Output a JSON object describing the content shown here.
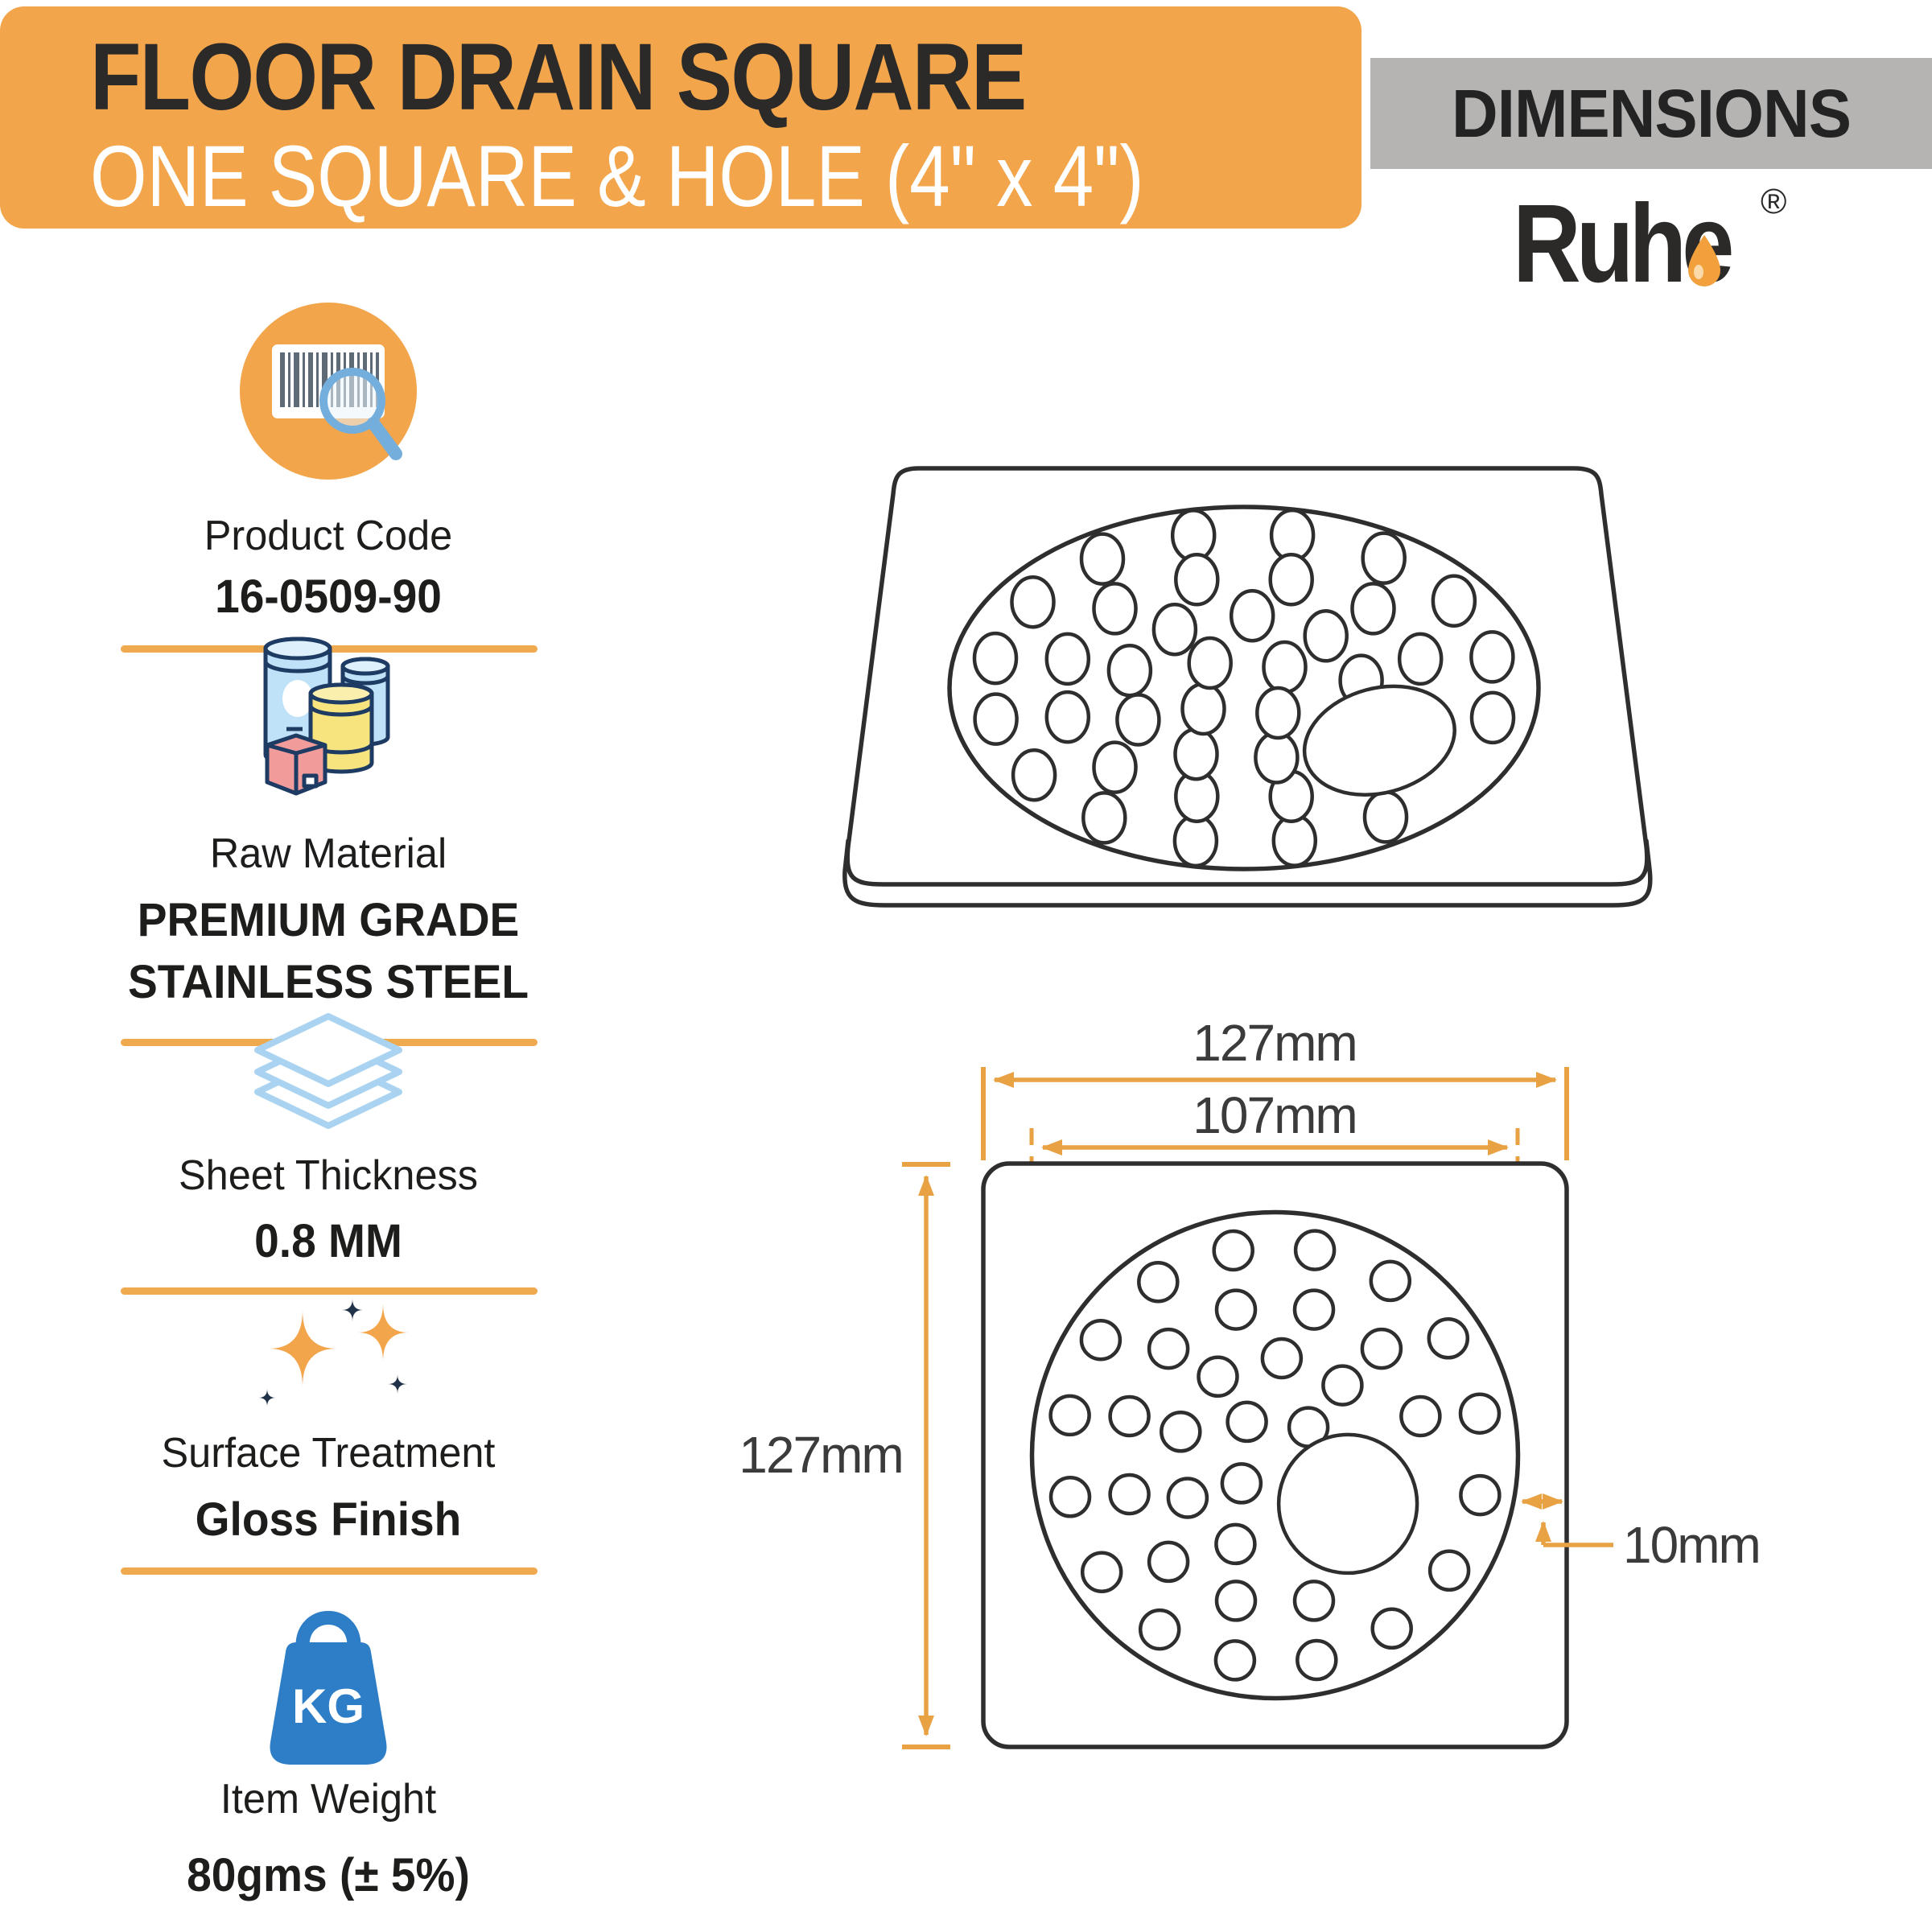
{
  "header": {
    "title_line1": "FLOOR DRAIN SQUARE",
    "title_line2": "ONE SQUARE & HOLE (4\" x 4\")"
  },
  "dimensions_panel": {
    "title": "DIMENSIONS"
  },
  "brand": {
    "name": "Ruhe",
    "registered_mark": "®"
  },
  "specs": [
    {
      "icon": "barcode-search-icon",
      "label": "Product Code",
      "value": "16-0509-90"
    },
    {
      "icon": "material-containers-icon",
      "label": "Raw Material",
      "value_line1": "PREMIUM GRADE",
      "value_line2": "STAINLESS STEEL"
    },
    {
      "icon": "sheet-stack-icon",
      "label": "Sheet Thickness",
      "value": "0.8 MM"
    },
    {
      "icon": "sparkles-icon",
      "label": "Surface Treatment",
      "value": "Gloss Finish"
    },
    {
      "icon": "kg-weight-icon",
      "label": "Item Weight",
      "value": "80gms (± 5%)"
    }
  ],
  "diagram": {
    "labels": {
      "outer_width": "127mm",
      "inner_width": "107mm",
      "outer_height": "127mm",
      "edge_offset": "10mm"
    },
    "pattern": {
      "hole_r": 0.078,
      "rings": [
        {
          "r": 0.86,
          "n": 16,
          "start": -79
        },
        {
          "r": 0.62,
          "n": 12,
          "start": -75
        },
        {
          "r": 0.4,
          "n": 9,
          "start": -86
        },
        {
          "r": 0.18,
          "n": 4,
          "start": -40
        }
      ]
    },
    "top_view": {
      "big_hole": {
        "dx": 0.46,
        "dy": 0.29,
        "r": 0.27
      }
    },
    "bottom_view": {
      "big_hole": {
        "dx": 0.3,
        "dy": 0.2,
        "r": 0.285
      }
    }
  },
  "colors": {
    "accent_orange": "#F2A54B",
    "line_orange": "#E9A243",
    "banner_gray": "#B5B4B3",
    "ink": "#2B2A29",
    "drawing_ink": "#2E2E2E",
    "icon_blue": "#2E7EC7",
    "icon_light_blue": "#A9D3F1",
    "icon_navy": "#1D3B63"
  }
}
